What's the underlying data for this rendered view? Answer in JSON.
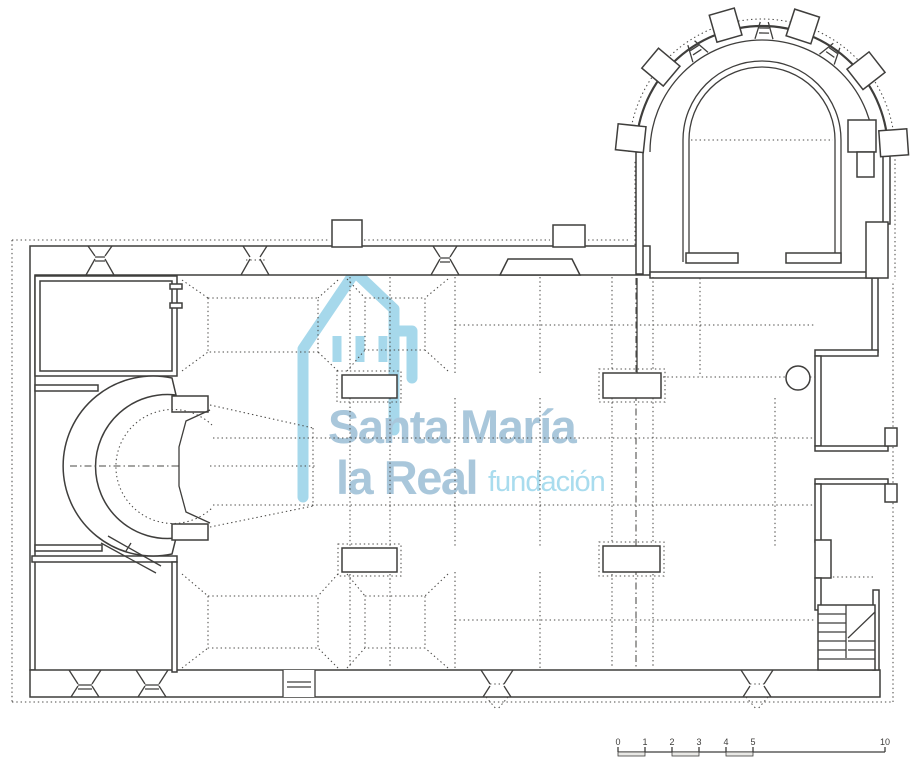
{
  "watermark": {
    "org_name_line1": "Santa María",
    "org_name_line2": "la Real",
    "org_suffix": "fundación",
    "icon": "church-tower-icon",
    "colors": {
      "icon": "#a6d8eb",
      "name": "#a9c7db",
      "suffix": "#a9dcee"
    }
  },
  "scale_bar": {
    "labels": [
      "0",
      "1",
      "2",
      "3",
      "4",
      "5",
      "10"
    ]
  },
  "drawing": {
    "ink_color": "#3f3e3c",
    "paper_color": "#ffffff"
  }
}
